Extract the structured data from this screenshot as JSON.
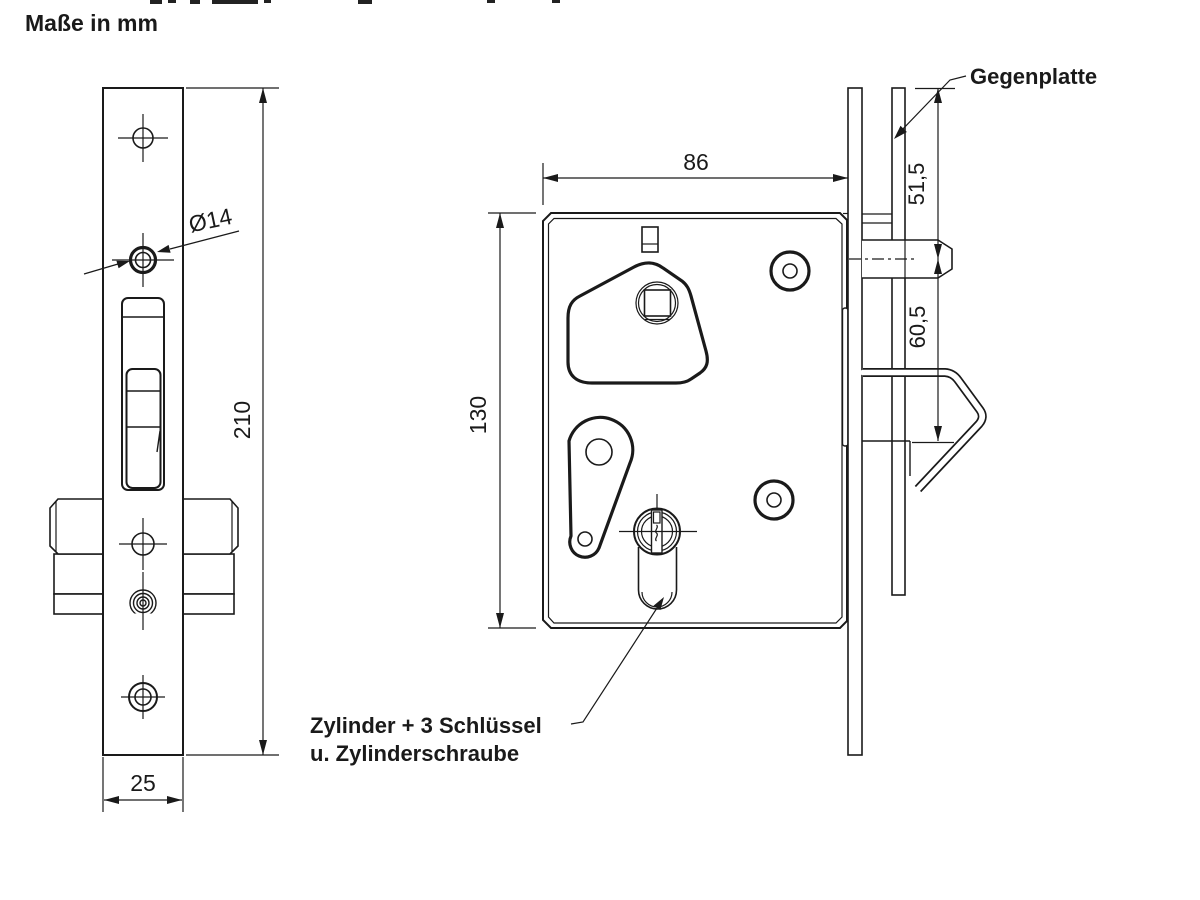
{
  "title": "Maße in mm",
  "annotations": {
    "gegenplatte_label": "Gegenplatte",
    "cylinder_label_line1": "Zylinder + 3 Schlüssel",
    "cylinder_label_line2": "u. Zylinderschraube"
  },
  "dimensions": {
    "faceplate_height_mm": "210",
    "faceplate_width_mm": "25",
    "roller_hole_diameter": "Ø14",
    "case_width_mm": "86",
    "case_height_mm": "130",
    "plate_top_to_bolt_mm": "51,5",
    "bolt_to_hook_mm": "60,5"
  },
  "colors": {
    "line": "#1a1a1a",
    "background": "#ffffff"
  }
}
